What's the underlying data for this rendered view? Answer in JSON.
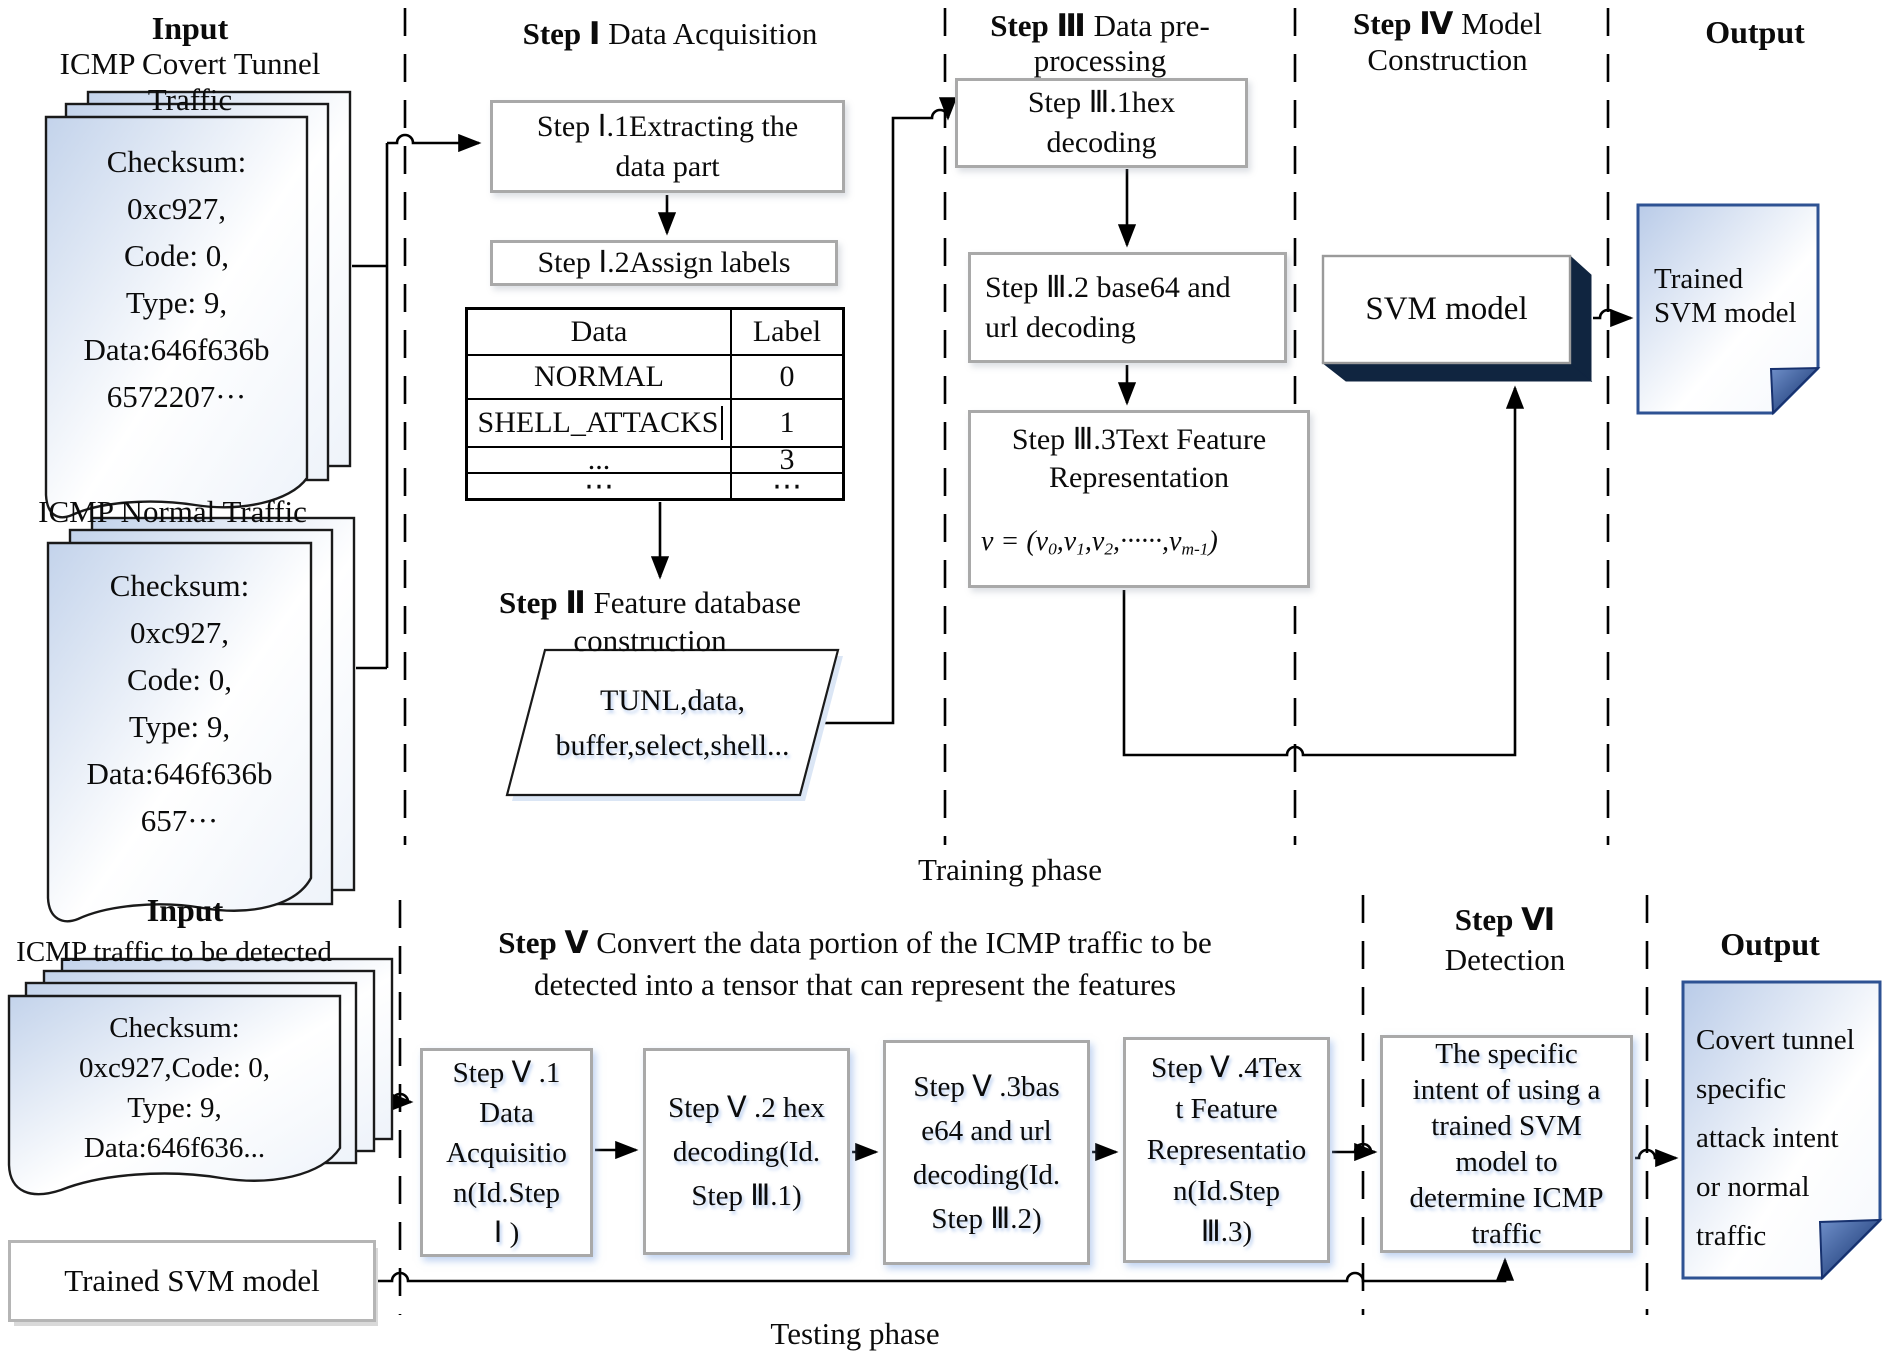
{
  "training": {
    "phase_label": "Training phase",
    "input": {
      "title": "Input",
      "covert_label": "ICMP Covert Tunnel Traffic",
      "covert_doc": [
        "Checksum:",
        "0xc927,",
        "Code: 0,",
        "Type: 9,",
        "Data:646f636b",
        "6572207···"
      ],
      "normal_label": "ICMP Normal Traffic",
      "normal_doc": [
        "Checksum:",
        "0xc927,",
        "Code: 0,",
        "Type: 9,",
        "Data:646f636b",
        "657···"
      ]
    },
    "step1": {
      "title_bold": "Step Ⅰ",
      "title_rest": " Data Acquisition",
      "box1": [
        "Step Ⅰ.1Extracting the",
        "data part"
      ],
      "box2": "Step Ⅰ.2Assign labels",
      "table": {
        "col1": "Data",
        "col2": "Label",
        "rows": [
          [
            "NORMAL",
            "0"
          ],
          [
            "SHELL_ATTACKS",
            "1"
          ],
          [
            "...",
            "3"
          ],
          [
            "⋯",
            "⋯"
          ]
        ]
      }
    },
    "step2": {
      "title_bold": "Step Ⅱ",
      "title_l1": " Feature database",
      "title_l2": "construction",
      "db": [
        "TUNL,data,",
        "buffer,select,shell..."
      ]
    },
    "step3": {
      "title_bold": "Step Ⅲ",
      "title_l1": " Data pre-",
      "title_l2": "processing",
      "box1": [
        "Step Ⅲ.1hex",
        "decoding"
      ],
      "box2": [
        "Step Ⅲ.2 base64 and",
        "url decoding"
      ],
      "box3": [
        "Step Ⅲ.3Text Feature",
        "Representation"
      ],
      "formula": [
        {
          "t": "v = ("
        },
        {
          "t": "v"
        },
        {
          "s": "0"
        },
        {
          "t": ","
        },
        {
          "t": "v"
        },
        {
          "s": "1"
        },
        {
          "t": ","
        },
        {
          "t": "v"
        },
        {
          "s": "2"
        },
        {
          "t": ",······,"
        },
        {
          "t": "v"
        },
        {
          "s": "m-1"
        },
        {
          "t": ")"
        }
      ]
    },
    "step4": {
      "title_bold": "Step Ⅳ",
      "title_l1": " Model",
      "title_l2": "Construction",
      "box": "SVM model"
    },
    "output": {
      "title": "Output",
      "note": [
        "Trained",
        "SVM model"
      ]
    }
  },
  "testing": {
    "phase_label": "Testing phase",
    "input": {
      "title": "Input",
      "label": "ICMP traffic to be detected",
      "doc": [
        "Checksum:",
        "0xc927,Code: 0,",
        "Type: 9,",
        "Data:646f636..."
      ],
      "trained_model_box": "Trained SVM model"
    },
    "step5": {
      "title_bold": "Step Ⅴ",
      "title_l1": " Convert the data portion of the ICMP traffic to be",
      "title_l2": "detected into a tensor that can represent the features",
      "box1": [
        "Step Ⅴ .1",
        "Data",
        "Acquisitio",
        "n(Id.Step",
        "Ⅰ )"
      ],
      "box2": [
        "Step Ⅴ .2 hex",
        "decoding(Id.",
        "Step Ⅲ.1)"
      ],
      "box3": [
        "Step Ⅴ .3bas",
        "e64 and url",
        "decoding(Id.",
        "Step Ⅲ.2)"
      ],
      "box4": [
        "Step Ⅴ .4Tex",
        "t Feature",
        "Representatio",
        "n(Id.Step",
        "Ⅲ.3)"
      ]
    },
    "step6": {
      "title_bold": "Step Ⅵ",
      "title_l2": "Detection",
      "box": [
        "The specific",
        "intent of using a",
        "trained SVM",
        "model to",
        "determine ICMP",
        "traffic"
      ]
    },
    "output": {
      "title": "Output",
      "note": [
        "Covert tunnel",
        "specific",
        "attack intent",
        "or normal",
        "traffic"
      ]
    }
  },
  "colors": {
    "accent_dark_navy": "#102540",
    "note_border_blue": "#2e5293",
    "doc_fill_blue": "#c7d5ec",
    "box_border_gray": "#a9a9a9"
  }
}
